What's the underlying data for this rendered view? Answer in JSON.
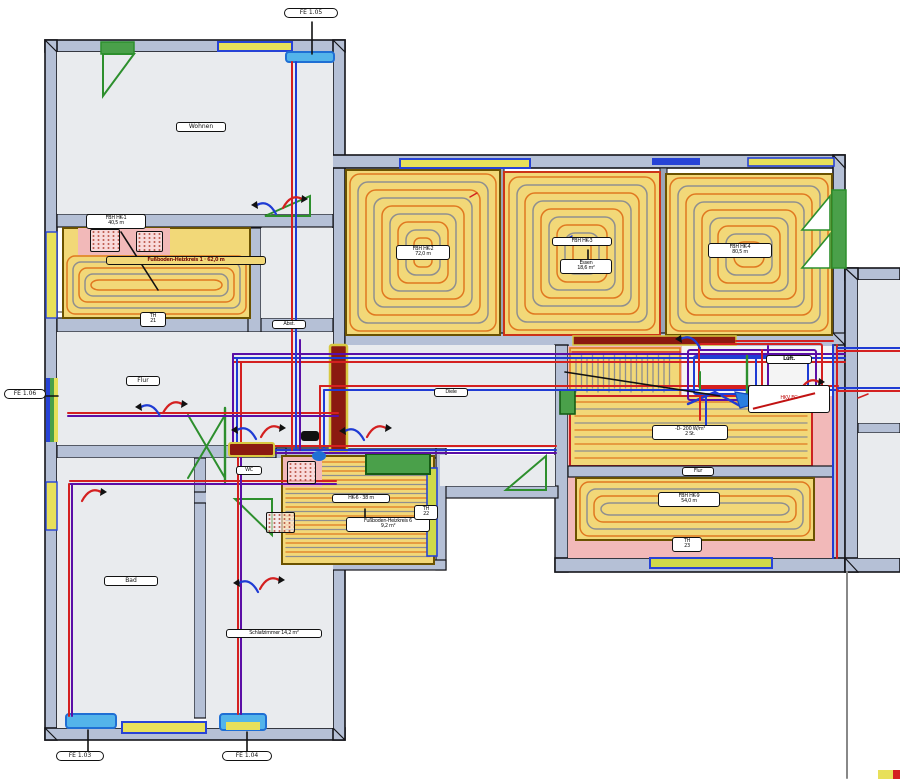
{
  "title": "Fußbodenheizung Grundriss",
  "colors": {
    "wall": "#b5c0d6",
    "wall_edge": "#15151a",
    "floor": "#e9ebee",
    "heat_yellow": "#f2d878",
    "heat_border": "#6b5200",
    "loop_orange": "#e07820",
    "loop_gray": "#8f8f8f",
    "pink": "#f2b9b9",
    "pipe_red": "#d42020",
    "pipe_blue": "#1f3bd4",
    "pipe_purple": "#5b0ea6",
    "green": "#2d8f2d",
    "green_fill": "#4aa04a",
    "window_cyan": "#53b4ea",
    "window_yellow": "#e8e05a",
    "window_lime": "#cfd94a",
    "window_blue": "#2743d6",
    "dark_red": "#8b1a10",
    "riser_edge": "#d8c840",
    "white_area": "#f4f4f4"
  },
  "labels": {
    "top_tag": "FE 1.05",
    "tl_room": "Wohnen",
    "z1_callout_1": "FBH HK-1",
    "z1_callout_2": "40,5 m",
    "z1_band": "Fußboden-Heizkreis 1 · 62,0 m",
    "z1_small_1": "TH",
    "z1_small_2": "21",
    "abst": "Abst.",
    "flur": "Flur",
    "left_tag": "FE 1.06",
    "diele": "Diele",
    "wc": "WC",
    "roomA_1": "FBH HK-2",
    "roomA_2": "72,0 m",
    "roomB_a": "FBH HK-3",
    "roomB_b1": "Essen",
    "roomB_b2": "18,6 m²",
    "roomC_1": "FBH HK-4",
    "roomC_2": "80,5 m",
    "bm_tag": "HK-6 · 38 m",
    "bm_callout_1": "Fußboden-Heizkreis 6",
    "bm_callout_2": "9,2 m²",
    "bm_small_1": "TH",
    "bm_small_2": "22",
    "z6_1": "-D- 200 W/m²",
    "z6_2": "2 St.",
    "mid_small": "Flur",
    "z7_1": "FBH HK-9",
    "z7_2": "54,0 m",
    "z7_small_1": "TH",
    "z7_small_2": "23",
    "luft": "Lüft.",
    "hkv": "HKV EG",
    "bad": "Bad",
    "schlaf": "Schlafzimmer 14,2 m²",
    "bl_tag": "FE 1.03",
    "bm_tag2": "FE 1.04"
  }
}
